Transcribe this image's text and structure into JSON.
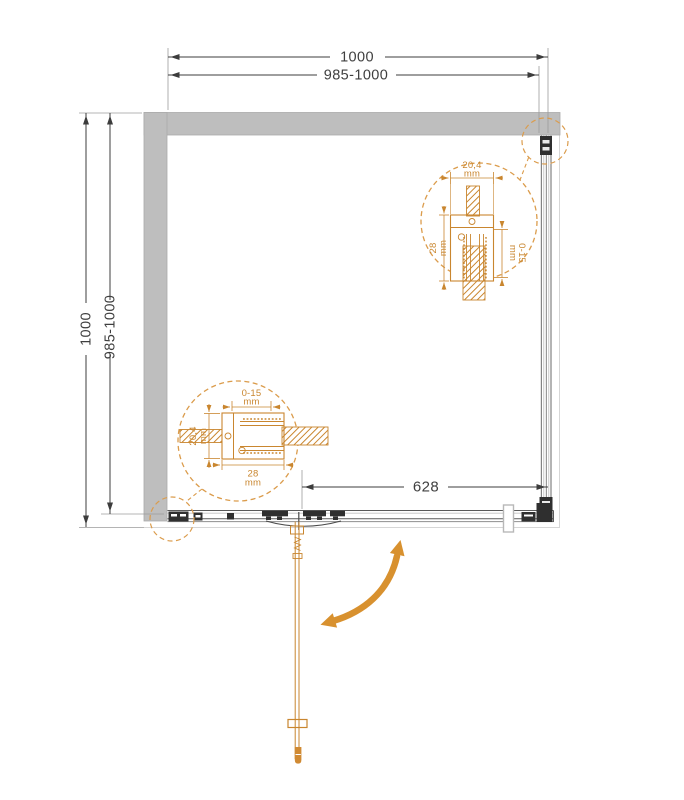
{
  "drawing": {
    "colors": {
      "accent_orange": "#C9862F",
      "arrow_orange": "#D8912F",
      "wall_gray": "#BEBEBE",
      "line_dark": "#3C3C3C"
    },
    "dims": {
      "top": {
        "total": "1000",
        "range": "985-1000"
      },
      "left": {
        "total": "1000",
        "range": "985-1000"
      },
      "entry": {
        "width": "628"
      }
    },
    "detail_top_right": {
      "profile_width": "20,4",
      "profile_depth": "28",
      "wall_adjust": "0-15",
      "unit": "mm"
    },
    "detail_bottom_left": {
      "wall_adjust": "0-15",
      "profile_width": "20,4",
      "profile_depth": "28",
      "unit": "mm"
    }
  }
}
